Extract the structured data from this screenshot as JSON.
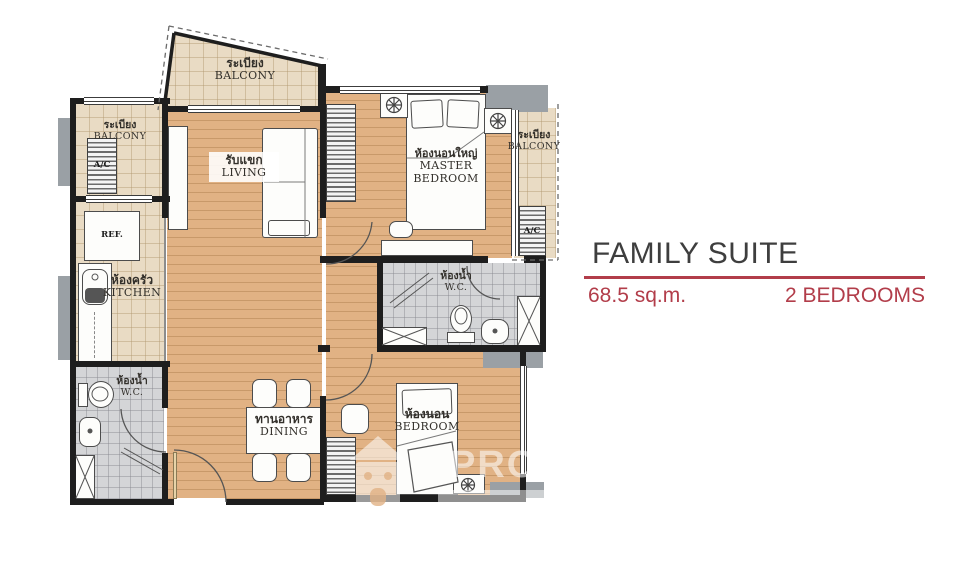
{
  "title": {
    "name": "FAMILY SUITE",
    "area": "68.5 sq.m.",
    "bedrooms": "2 BEDROOMS"
  },
  "rooms": {
    "balcony_top": {
      "thai": "ระเบียง",
      "en": "BALCONY"
    },
    "balcony_left": {
      "thai": "ระเบียง",
      "en": "BALCONY"
    },
    "balcony_right": {
      "thai": "ระเบียง",
      "en": "BALCONY"
    },
    "living": {
      "thai": "รับแขก",
      "en": "LIVING"
    },
    "master_bedroom": {
      "thai": "ห้องนอนใหญ่",
      "en": "MASTER BEDROOM"
    },
    "kitchen": {
      "thai": "ห้องครัว",
      "en": "KITCHEN"
    },
    "wc_master": {
      "thai": "ห้องน้ำ",
      "en": "W.C."
    },
    "wc_common": {
      "thai": "ห้องน้ำ",
      "en": "W.C."
    },
    "dining": {
      "thai": "ทานอาหาร",
      "en": "DINING"
    },
    "bedroom": {
      "thai": "ห้องนอน",
      "en": "BEDROOM"
    }
  },
  "appliances": {
    "refrigerator": "REF.",
    "ac_balcony_left": "A/C",
    "ac_balcony_right": "A/C"
  },
  "watermark": {
    "letters": "PRO"
  },
  "colors": {
    "accent_red": "#b23d4a",
    "title_text": "#3e3e3e",
    "wall": "#1e1e1e",
    "wood_floor": "#e1b284",
    "tile_beige": "#e9dbc4",
    "tile_gray": "#d4d5d7",
    "gray_block": "#9aa0a5"
  }
}
